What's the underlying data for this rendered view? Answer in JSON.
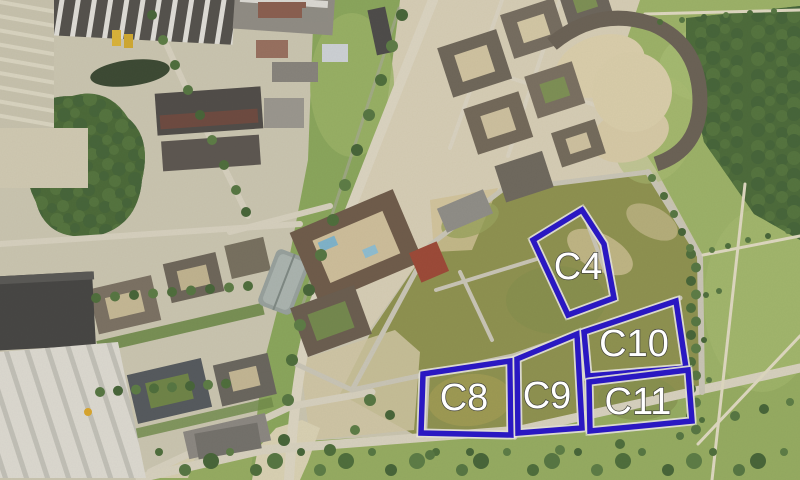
{
  "map": {
    "annotation_color": "#2a18c2",
    "halo_color": "#ffffff",
    "label_color": "#ffffff",
    "label_outline_color": "#44443c",
    "parcels": [
      {
        "label": "C4",
        "points": "582,210 604,244 614,298 568,315 533,240",
        "label_x": 578,
        "label_y": 267
      },
      {
        "label": "C8",
        "points": "423,374 510,361 511,435 421,433",
        "label_x": 464,
        "label_y": 398
      },
      {
        "label": "C9",
        "points": "517,359 577,334 582,428 518,433",
        "label_x": 547,
        "label_y": 396
      },
      {
        "label": "C10",
        "points": "584,332 676,301 686,368 588,376",
        "label_x": 634,
        "label_y": 344
      },
      {
        "label": "C11",
        "points": "589,382 688,370 692,421 590,431",
        "label_x": 638,
        "label_y": 402
      }
    ]
  }
}
